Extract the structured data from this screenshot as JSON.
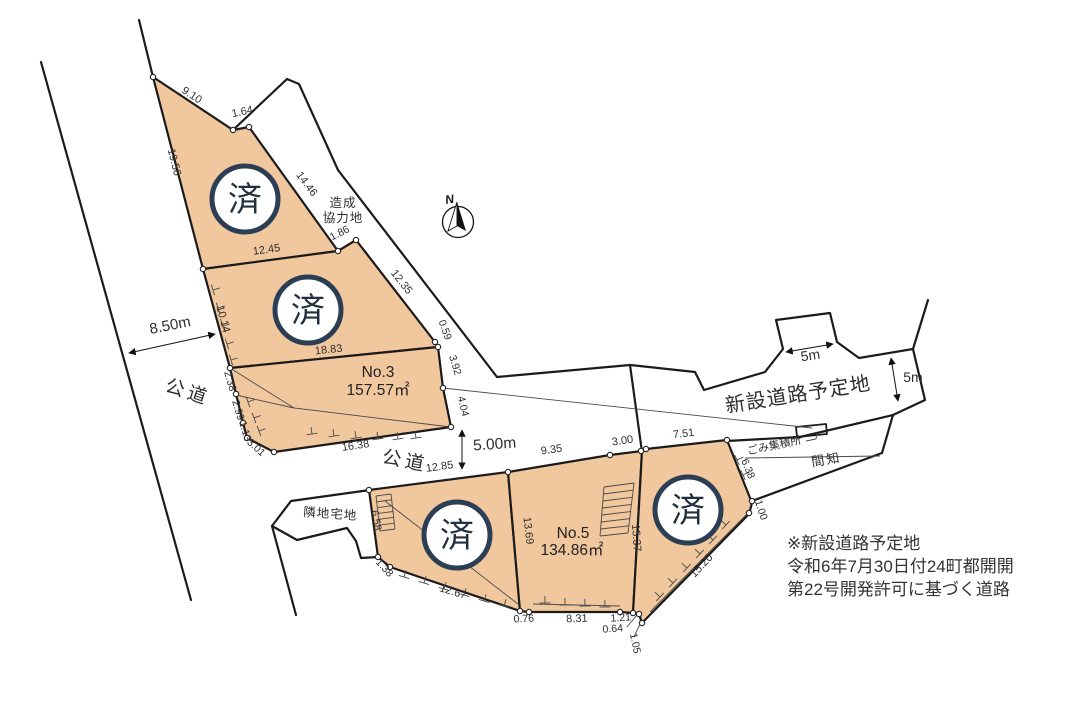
{
  "title": "土地区画図",
  "colors": {
    "parcel_fill": "#f1c79e",
    "boundary": "#1b1b1b",
    "status_ring": "#2c3e54",
    "status_text": "#223040",
    "text": "#2b2b2b"
  },
  "compass": {
    "label": "N"
  },
  "parcels": {
    "no3": {
      "name": "No.3",
      "area": "157.57㎡",
      "x": 378,
      "y": 377
    },
    "no5": {
      "name": "No.5",
      "area": "134.86㎡",
      "x": 573,
      "y": 538
    },
    "sold_status": "済"
  },
  "status_circles": [
    {
      "x": 245,
      "y": 199
    },
    {
      "x": 308,
      "y": 310
    },
    {
      "x": 457,
      "y": 535
    },
    {
      "x": 688,
      "y": 510
    }
  ],
  "note": {
    "line1": "※新設道路予定地",
    "line2": "令和6年7月30日付24町都開開",
    "line3": "第22号開発許可に基づく道路"
  },
  "labels": [
    {
      "id": "dim-9-10",
      "text": "9.10",
      "x": 190,
      "y": 98,
      "r": 33,
      "s": 11
    },
    {
      "id": "dim-1-64",
      "text": "1.64",
      "x": 243,
      "y": 115,
      "r": -12,
      "s": 11
    },
    {
      "id": "dim-19-56",
      "text": "19.56",
      "x": 171,
      "y": 163,
      "r": 76,
      "s": 11
    },
    {
      "id": "dim-14-46",
      "text": "14.46",
      "x": 304,
      "y": 186,
      "r": 53,
      "s": 11
    },
    {
      "id": "dim-12-45",
      "text": "12.45",
      "x": 267,
      "y": 253,
      "r": -8,
      "s": 11
    },
    {
      "id": "dim-1-86",
      "text": "1.86",
      "x": 341,
      "y": 236,
      "r": -27,
      "s": 10.5
    },
    {
      "id": "area-zosei-line1",
      "text": "造成",
      "x": 343,
      "y": 207,
      "r": 0,
      "s": 12.5,
      "ls": 1
    },
    {
      "id": "area-zosei-line2",
      "text": "協力地",
      "x": 343,
      "y": 222,
      "r": 0,
      "s": 12.5,
      "ls": 1
    },
    {
      "id": "dim-12-35",
      "text": "12.35",
      "x": 399,
      "y": 284,
      "r": 52,
      "s": 11
    },
    {
      "id": "dim-0-59",
      "text": "0.59",
      "x": 442,
      "y": 331,
      "r": 70,
      "s": 10.5
    },
    {
      "id": "dim-18-83",
      "text": "18.83",
      "x": 329,
      "y": 353,
      "r": -6,
      "s": 11
    },
    {
      "id": "dim-10-14",
      "text": "10.14",
      "x": 220,
      "y": 320,
      "r": 75,
      "s": 11
    },
    {
      "id": "dim-3-92",
      "text": "3.92",
      "x": 452,
      "y": 366,
      "r": 73,
      "s": 10.5
    },
    {
      "id": "dim-4-04",
      "text": "4.04",
      "x": 460,
      "y": 407,
      "r": 77,
      "s": 10.5
    },
    {
      "id": "dim-2-38",
      "text": "2.38",
      "x": 227,
      "y": 382,
      "r": 74,
      "s": 10.5
    },
    {
      "id": "dim-2-99",
      "text": "2.99",
      "x": 235,
      "y": 411,
      "r": 74,
      "s": 10.5
    },
    {
      "id": "dim-1-13",
      "text": "1.13",
      "x": 242,
      "y": 432,
      "r": 74,
      "s": 10.5
    },
    {
      "id": "dim-3-01",
      "text": "3.01",
      "x": 254,
      "y": 450,
      "r": 42,
      "s": 10.5
    },
    {
      "id": "dim-16-38",
      "text": "16.38",
      "x": 356,
      "y": 449,
      "r": -8,
      "s": 11
    },
    {
      "id": "dim-8-50m",
      "text": "8.50m",
      "x": 171,
      "y": 330,
      "r": -11,
      "s": 15
    },
    {
      "id": "road-left-label",
      "text": "公道",
      "x": 186,
      "y": 398,
      "r": 18,
      "s": 19,
      "ls": 4
    },
    {
      "id": "road-mid-label",
      "text": "公道",
      "x": 404,
      "y": 467,
      "r": 11,
      "s": 19,
      "ls": 4
    },
    {
      "id": "dim-12-85",
      "text": "12.85",
      "x": 440,
      "y": 470,
      "r": -8,
      "s": 11
    },
    {
      "id": "dim-5-00m",
      "text": "5.00m",
      "x": 495,
      "y": 449,
      "r": -4,
      "s": 15.5
    },
    {
      "id": "dim-9-35",
      "text": "9.35",
      "x": 552,
      "y": 453,
      "r": -8,
      "s": 11
    },
    {
      "id": "dim-3-00",
      "text": "3.00",
      "x": 623,
      "y": 444,
      "r": -8,
      "s": 11
    },
    {
      "id": "dim-7-51",
      "text": "7.51",
      "x": 684,
      "y": 437,
      "r": -7,
      "s": 11
    },
    {
      "id": "road-planned-label",
      "text": "新設道路予定地",
      "x": 799,
      "y": 401,
      "r": -9,
      "s": 20,
      "ls": 1
    },
    {
      "id": "dim-5m-top",
      "text": "5m",
      "x": 811,
      "y": 360,
      "r": -8,
      "s": 14
    },
    {
      "id": "dim-5m-right",
      "text": "5m",
      "x": 913,
      "y": 382,
      "r": 0,
      "s": 14
    },
    {
      "id": "label-gomi",
      "text": "ごみ集積所",
      "x": 775,
      "y": 449,
      "r": -12,
      "s": 11
    },
    {
      "id": "label-kenchi",
      "text": "間知",
      "x": 827,
      "y": 464,
      "r": -9,
      "s": 13,
      "ls": 2
    },
    {
      "id": "label-rinchi",
      "text": "隣地宅地",
      "x": 330,
      "y": 518,
      "r": 4,
      "s": 12.5,
      "ls": 1
    },
    {
      "id": "dim-6-58",
      "text": "6.58",
      "x": 373,
      "y": 521,
      "r": 80,
      "s": 10.5
    },
    {
      "id": "dim-1-38",
      "text": "1.38",
      "x": 382,
      "y": 570,
      "r": 48,
      "s": 10.5
    },
    {
      "id": "dim-12-67",
      "text": "12.67",
      "x": 452,
      "y": 595,
      "r": 17,
      "s": 11
    },
    {
      "id": "dim-0-76",
      "text": "0.76",
      "x": 524,
      "y": 622,
      "r": -3,
      "s": 10.5
    },
    {
      "id": "dim-8-31",
      "text": "8.31",
      "x": 577,
      "y": 622,
      "r": -2,
      "s": 11
    },
    {
      "id": "dim-13-69",
      "text": "13.69",
      "x": 525,
      "y": 531,
      "r": 83,
      "s": 11
    },
    {
      "id": "dim-15-37",
      "text": "15.37",
      "x": 633,
      "y": 538,
      "r": 86,
      "s": 11
    },
    {
      "id": "dim-1-21",
      "text": "1.21",
      "x": 621,
      "y": 621,
      "r": -4,
      "s": 10.5
    },
    {
      "id": "dim-0-64",
      "text": "0.64",
      "x": 613,
      "y": 632,
      "r": -4,
      "s": 10.5
    },
    {
      "id": "dim-1-05",
      "text": "1.05",
      "x": 632,
      "y": 644,
      "r": 78,
      "s": 10.5
    },
    {
      "id": "dim-15-20",
      "text": "15.20",
      "x": 704,
      "y": 568,
      "r": -47,
      "s": 11
    },
    {
      "id": "dim-6-38",
      "text": "6.38",
      "x": 745,
      "y": 470,
      "r": 68,
      "s": 10.5
    },
    {
      "id": "dim-1-00",
      "text": "1.00",
      "x": 758,
      "y": 511,
      "r": 72,
      "s": 10.5
    }
  ]
}
